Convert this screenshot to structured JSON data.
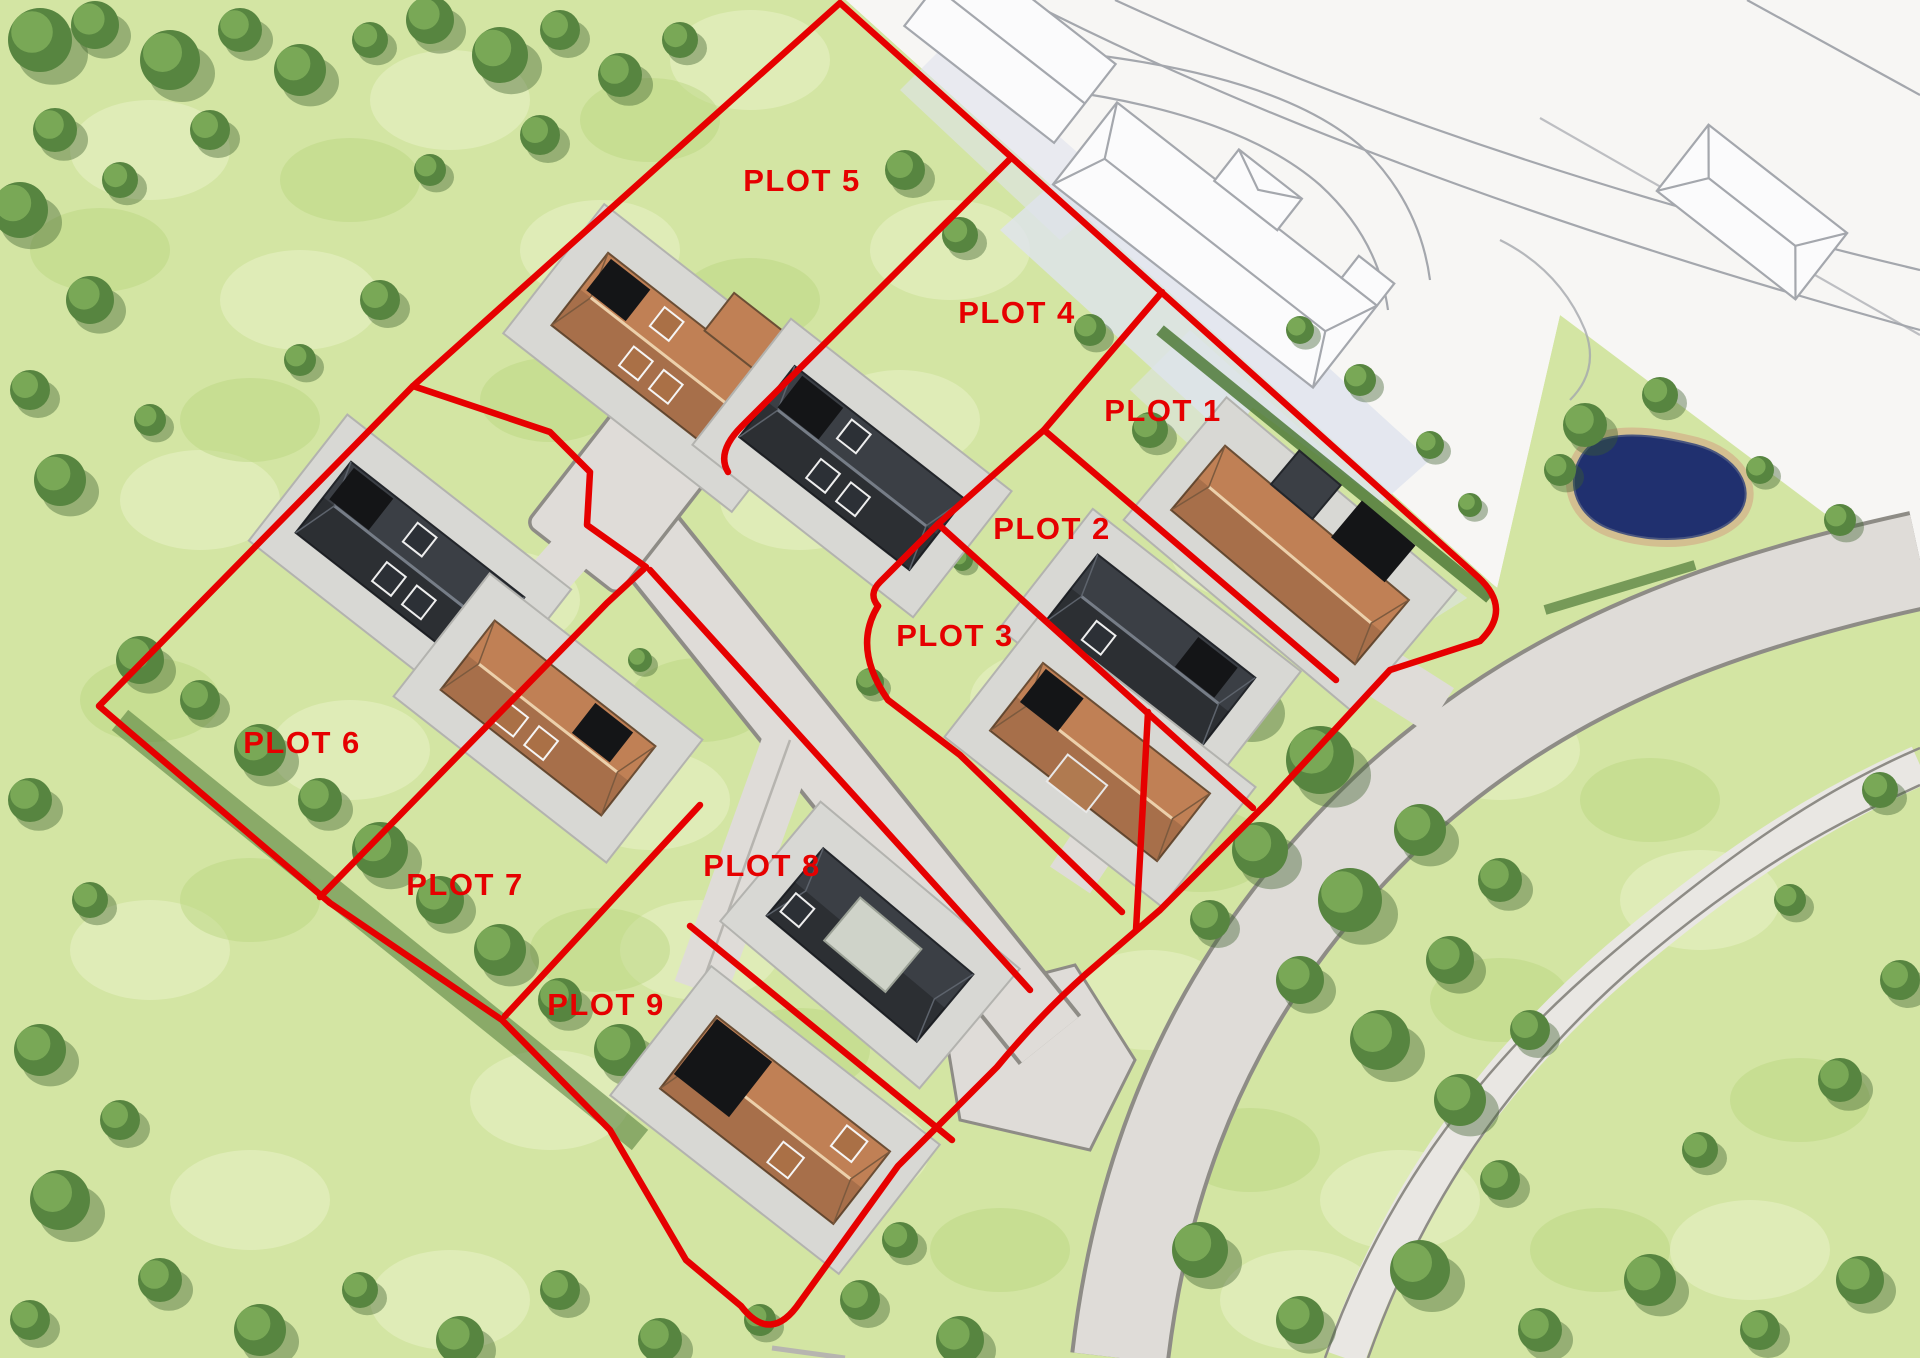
{
  "title": "Development site plan with numbered plots",
  "plots": [
    {
      "id": 1,
      "label": "PLOT 1"
    },
    {
      "id": 2,
      "label": "PLOT 2"
    },
    {
      "id": 3,
      "label": "PLOT 3"
    },
    {
      "id": 4,
      "label": "PLOT 4"
    },
    {
      "id": 5,
      "label": "PLOT 5"
    },
    {
      "id": 6,
      "label": "PLOT 6"
    },
    {
      "id": 7,
      "label": "PLOT 7"
    },
    {
      "id": 8,
      "label": "PLOT 8"
    },
    {
      "id": 9,
      "label": "PLOT 9"
    }
  ],
  "palette": {
    "boundary-red": "#e60000",
    "label-red": "#e60000",
    "grass": "#d3e5a3",
    "grass-light": "#eaf2c8",
    "grass-dark": "#b7d47e",
    "tree": "#578540",
    "tree-light": "#7fae5a",
    "tree-dark": "#3c5f2c",
    "hedge": "#4f7a38",
    "road": "#dfdcd8",
    "road-edge": "#8e8c86",
    "pad": "#d8d8d4",
    "roof-orange": "#c08055",
    "roof-dark": "#3b3f45",
    "panel-black": "#141517",
    "panel-pale": "#cfd3c9",
    "white-area": "#f7f6f4",
    "outline": "#a4a7ad",
    "shadow": "#dfe3ed",
    "pond": "#20306f",
    "sand": "#d3bf90"
  }
}
